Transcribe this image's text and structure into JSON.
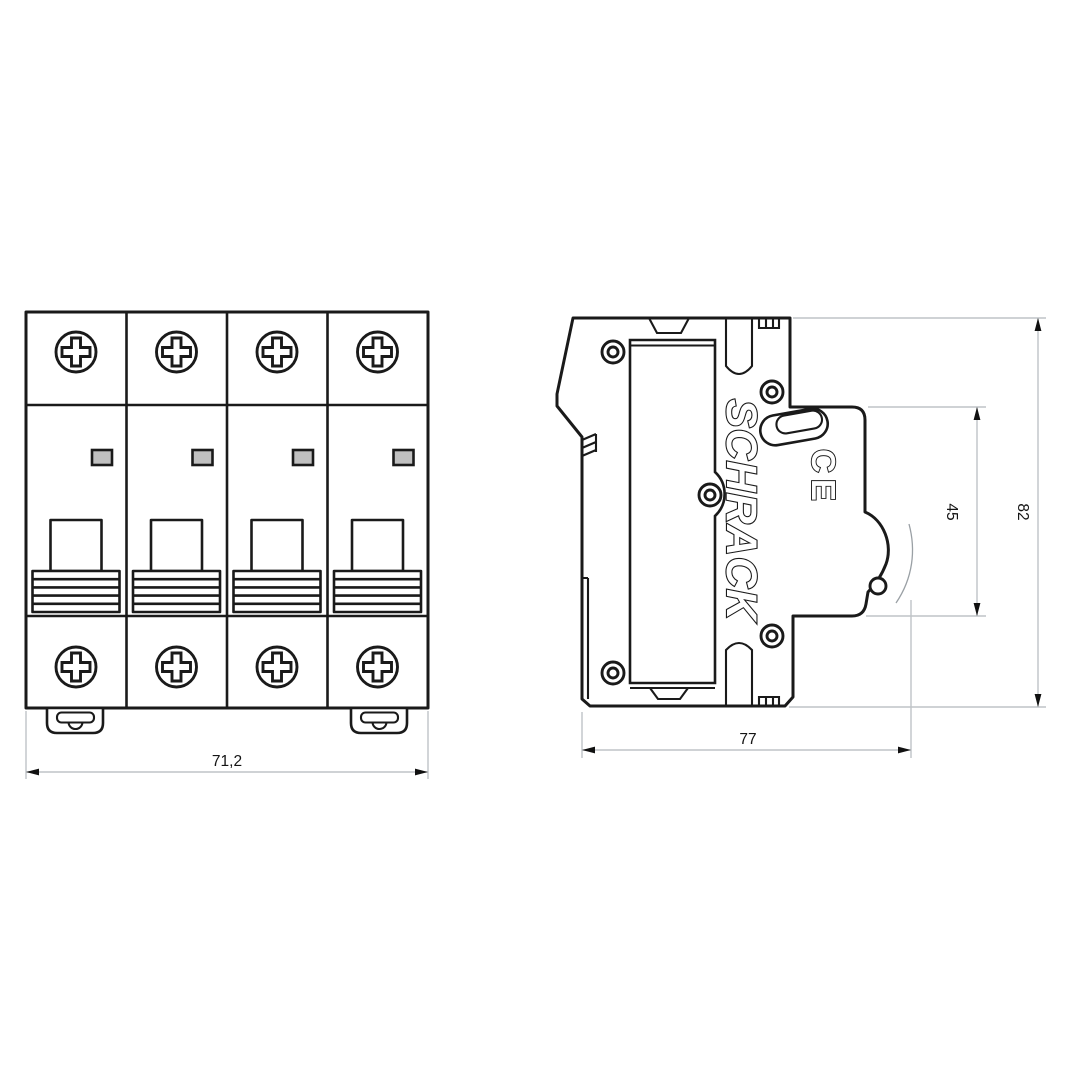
{
  "page": {
    "background": "#ffffff"
  },
  "drawing": {
    "type": "technical-dimension-drawing",
    "product": "4-pole miniature circuit breaker, front and side views",
    "brand_text": "SCHRACK",
    "ce_mark_text": "CE",
    "colors": {
      "outline": "#1a1a1a",
      "dimension_lines": "#bfc3c7",
      "arrows_and_text": "#111111",
      "indicator_fill": "#c0c0c0"
    },
    "front_view": {
      "label": "front view",
      "poles": 4,
      "dim_width": "71,2"
    },
    "side_view": {
      "label": "side view",
      "dim_depth": "77",
      "dim_front_height": "45",
      "dim_total_height": "82"
    }
  }
}
